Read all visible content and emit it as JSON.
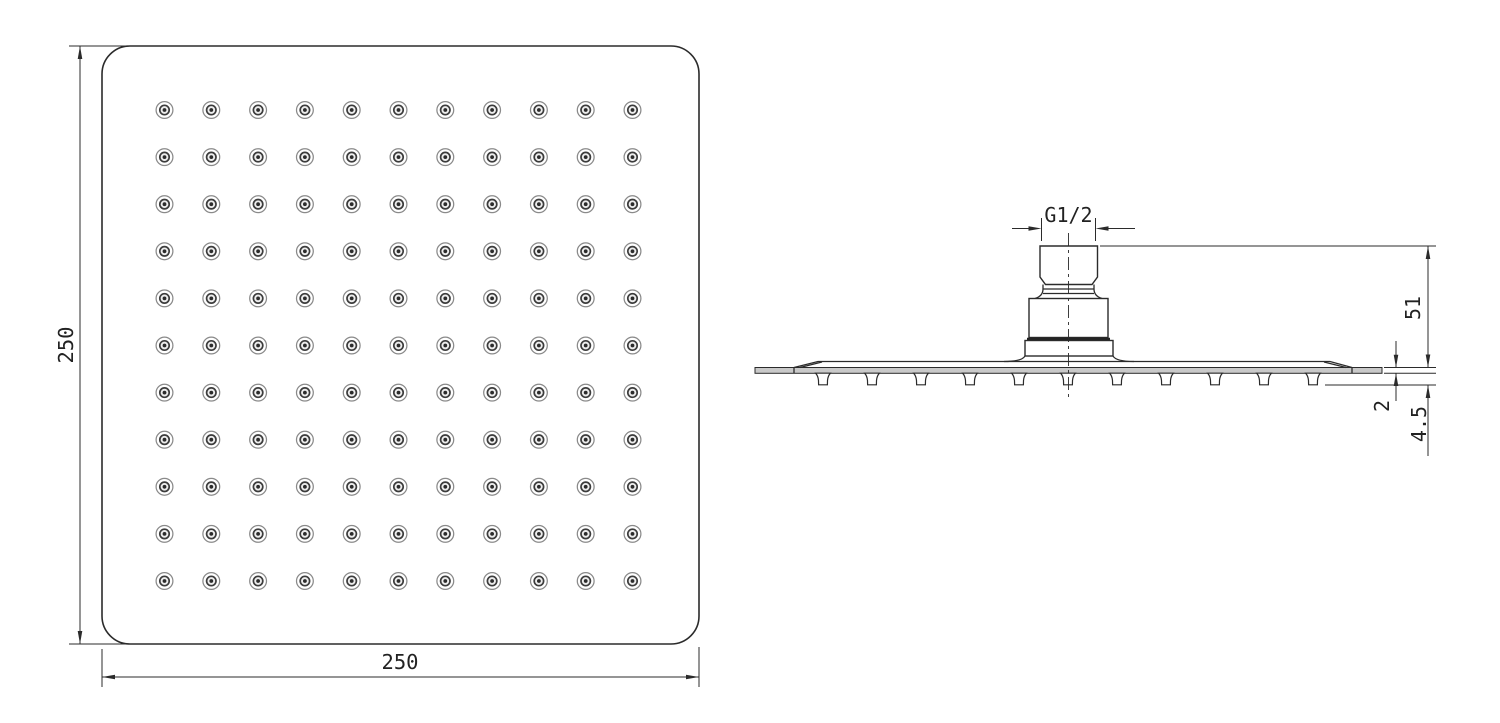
{
  "drawing": {
    "description": "Square shower head technical drawing, two orthographic views",
    "top_view": {
      "width_label": "250",
      "height_label": "250",
      "grid": {
        "rows": 11,
        "cols": 11,
        "x_start": 164.5,
        "y_start": 110,
        "x_step": 46.8,
        "y_step": 47.1,
        "r_outer": 8.4,
        "r_mid": 4.7,
        "r_dot": 1.9
      }
    },
    "side_view": {
      "thread_label": "G1/2",
      "height_label": "51",
      "plate_thickness_label": "2",
      "overall_thickness_label": "4.5",
      "nozzles": {
        "count": 11,
        "x_start": 823,
        "x_step": 49,
        "top_y": 373.2,
        "bottom_y": 384.8
      }
    },
    "colors": {
      "line": "#2b2b2b",
      "plate_fill": "#c9c9c9",
      "background": "#ffffff"
    }
  }
}
